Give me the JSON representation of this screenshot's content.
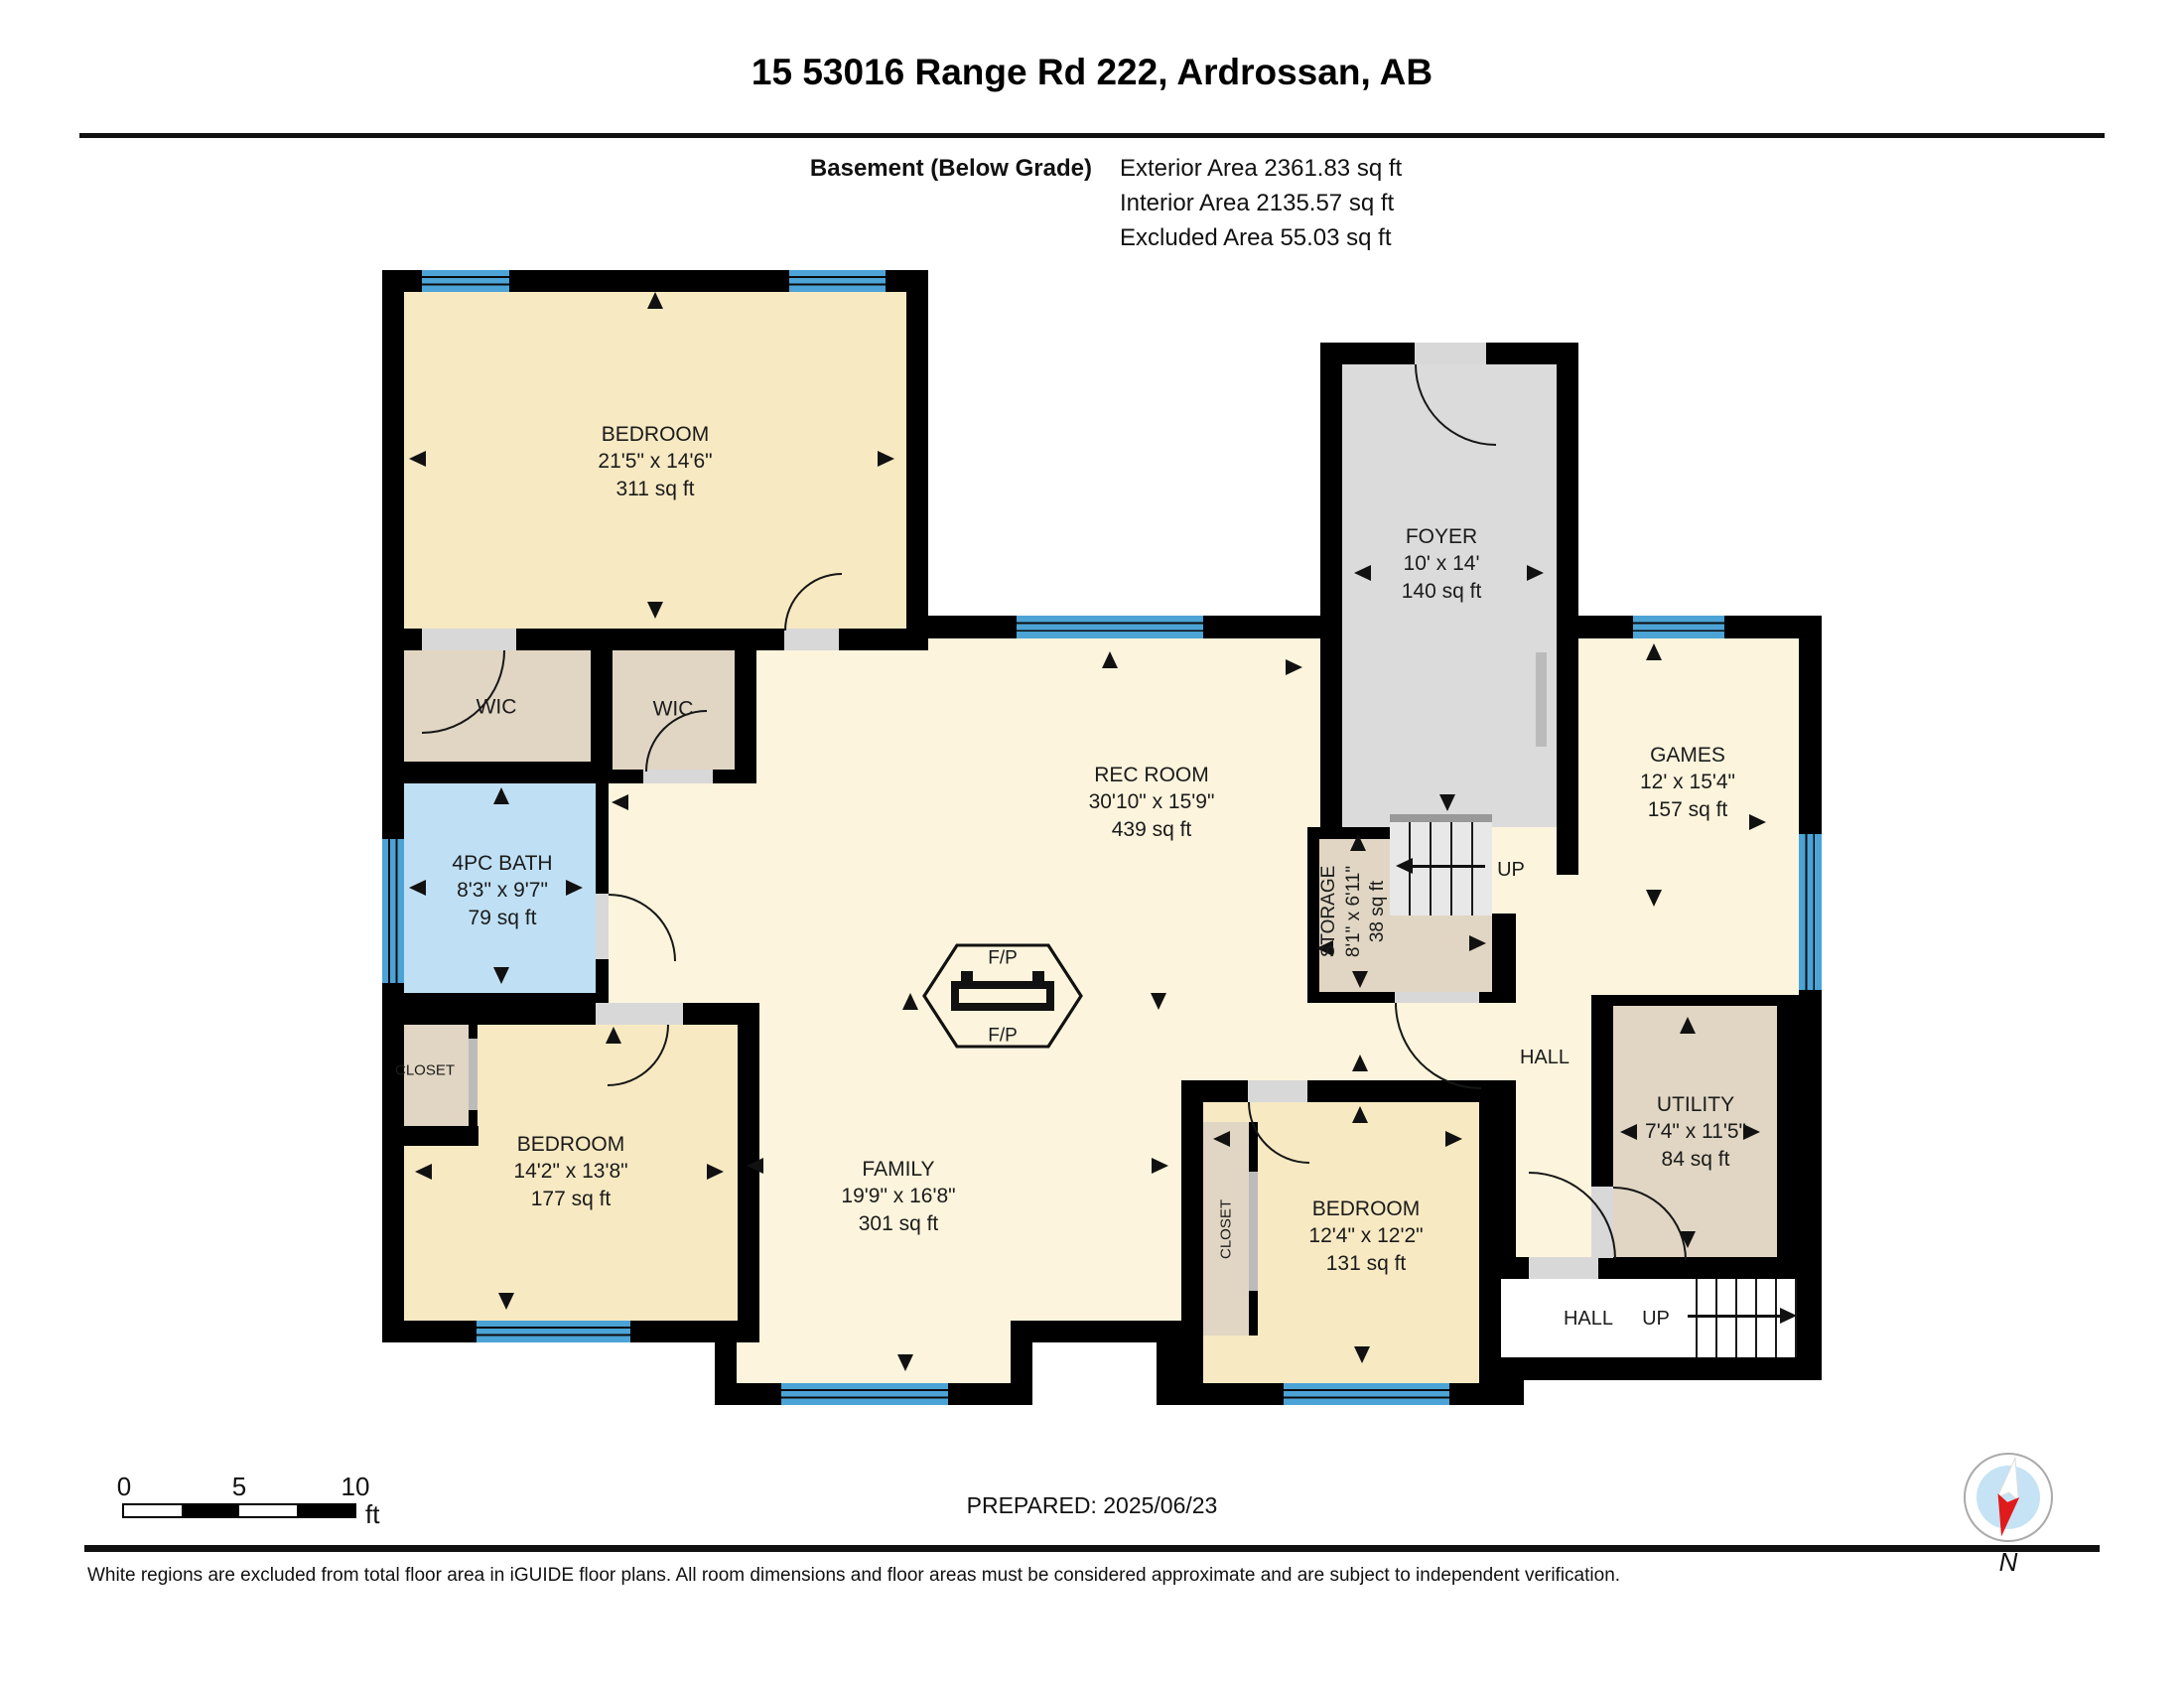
{
  "header": {
    "title": "15 53016 Range Rd 222, Ardrossan, AB",
    "floor_label": "Basement (Below Grade)",
    "exterior_area": "Exterior Area 2361.83 sq ft",
    "interior_area": "Interior Area 2135.57 sq ft",
    "excluded_area": "Excluded Area 55.03 sq ft"
  },
  "rooms": {
    "bedroom_tl": {
      "name": "BEDROOM",
      "dims": "21'5\" x 14'6\"",
      "area": "311 sq ft"
    },
    "wic": {
      "name": "WIC"
    },
    "bath": {
      "name": "4PC BATH",
      "dims": "8'3\" x 9'7\"",
      "area": "79 sq ft"
    },
    "rec_room": {
      "name": "REC ROOM",
      "dims": "30'10\" x 15'9\"",
      "area": "439 sq ft"
    },
    "foyer": {
      "name": "FOYER",
      "dims": "10' x 14'",
      "area": "140 sq ft"
    },
    "storage": {
      "name": "STORAGE",
      "dims": "8'1\" x 6'11\"",
      "area": "38 sq ft"
    },
    "games": {
      "name": "GAMES",
      "dims": "12' x 15'4\"",
      "area": "157 sq ft"
    },
    "utility": {
      "name": "UTILITY",
      "dims": "7'4\" x 11'5\"",
      "area": "84 sq ft"
    },
    "family": {
      "name": "FAMILY",
      "dims": "19'9\" x 16'8\"",
      "area": "301 sq ft"
    },
    "bedroom_bl": {
      "name": "BEDROOM",
      "dims": "14'2\" x 13'8\"",
      "area": "177 sq ft"
    },
    "bedroom_mid": {
      "name": "BEDROOM",
      "dims": "12'4\" x 12'2\"",
      "area": "131 sq ft"
    },
    "closet": {
      "name": "CLOSET"
    },
    "hall": {
      "name": "HALL"
    }
  },
  "labels": {
    "up": "UP",
    "fp": "F/P",
    "north": "N"
  },
  "scale_bar": {
    "tick0": "0",
    "tick5": "5",
    "tick10": "10",
    "unit": "ft"
  },
  "footer": {
    "prepared": "PREPARED: 2025/06/23",
    "disclaimer": "White regions are excluded from total floor area in iGUIDE floor plans. All room dimensions and floor areas must be considered approximate and are subject to independent verification."
  }
}
